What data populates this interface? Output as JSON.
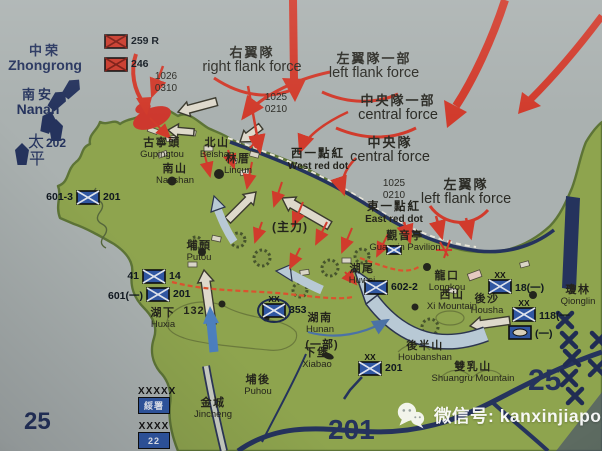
{
  "colors": {
    "sea": "#aab1b0",
    "land": "#8ea44b",
    "land_edge": "#5c7434",
    "navy": "#24335f",
    "red": "#d63a2a",
    "blue_unit": "#2e57a5",
    "white_arrow": "#ded9ca",
    "blue_arrow": "#b7c9d6",
    "text": "#26261e",
    "road_light": "#c9cdc2",
    "watermark": "#fdfdfd"
  },
  "sea_labels": [
    {
      "zh": "中荣",
      "en": "Zhongrong",
      "x": 45,
      "y": 44
    },
    {
      "zh": "南安",
      "en": "Nanan",
      "x": 38,
      "y": 88
    }
  ],
  "ship_group": {
    "name_vertical": [
      "太",
      "平"
    ],
    "number": "202"
  },
  "force_labels": [
    {
      "zh": "右翼隊",
      "en": "right flank force",
      "x": 252,
      "y": 46
    },
    {
      "zh": "左翼隊一部",
      "en": "left flank force",
      "x": 374,
      "y": 52
    },
    {
      "zh": "中央隊一部",
      "en": "central force",
      "x": 398,
      "y": 94
    },
    {
      "zh": "中央隊",
      "en": "central force",
      "x": 390,
      "y": 136
    },
    {
      "zh": "左翼隊",
      "en": "left flank force",
      "x": 466,
      "y": 178
    }
  ],
  "red_dot_labels": [
    {
      "zh": "西一點紅",
      "en": "West red dot",
      "x": 318,
      "y": 148
    },
    {
      "zh": "東一點紅",
      "en": "East red dot",
      "x": 394,
      "y": 201
    }
  ],
  "timestamps": [
    {
      "l1": "1026",
      "l2": "0310",
      "x": 166,
      "y": 71
    },
    {
      "l1": "1025",
      "l2": "0210",
      "x": 276,
      "y": 92
    },
    {
      "l1": "1025",
      "l2": "0210",
      "x": 394,
      "y": 178
    }
  ],
  "places": [
    {
      "zh": "古寧頭",
      "en": "Gupingtou",
      "x": 162,
      "y": 138
    },
    {
      "zh": "北山",
      "en": "Beishan",
      "x": 217,
      "y": 138
    },
    {
      "zh": "林厝",
      "en": "Lincun",
      "x": 238,
      "y": 154
    },
    {
      "zh": "南山",
      "en": "Nanshan",
      "x": 175,
      "y": 164
    },
    {
      "zh": "埔頭",
      "en": "Putou",
      "x": 199,
      "y": 241
    },
    {
      "zh": "湖下",
      "en": "Huxia",
      "x": 163,
      "y": 308
    },
    {
      "zh": "湖尾",
      "en": "Huwei",
      "x": 362,
      "y": 264
    },
    {
      "zh": "湖南",
      "en": "Hunan",
      "x": 320,
      "y": 313
    },
    {
      "zh": "下堡",
      "en": "Xiabao",
      "x": 317,
      "y": 348
    },
    {
      "zh": "埔後",
      "en": "Puhou",
      "x": 258,
      "y": 375
    },
    {
      "zh": "金城",
      "en": "Jincheng",
      "x": 213,
      "y": 398
    },
    {
      "zh": "觀音亭",
      "en": "Guanyin Pavilion",
      "x": 405,
      "y": 231
    },
    {
      "zh": "龍口",
      "en": "Longkou",
      "x": 447,
      "y": 271
    },
    {
      "zh": "西山",
      "en": "Xi Mountain",
      "x": 452,
      "y": 290
    },
    {
      "zh": "後沙",
      "en": "Housha",
      "x": 487,
      "y": 294
    },
    {
      "zh": "瓊林",
      "en": "Qionglin",
      "x": 578,
      "y": 285
    },
    {
      "zh": "後半山",
      "en": "Houbanshan",
      "x": 425,
      "y": 341
    },
    {
      "zh": "雙乳山",
      "en": "Shuangru Mountain",
      "x": 473,
      "y": 362
    }
  ],
  "annotations": [
    {
      "text": "(主力)",
      "x": 290,
      "y": 218,
      "size": 12
    },
    {
      "text": "(一部)",
      "x": 322,
      "y": 336,
      "size": 11
    },
    {
      "text": "132",
      "x": 194,
      "y": 305,
      "size": 11
    }
  ],
  "units": [
    {
      "side": "red",
      "post": "259 R",
      "x": 104,
      "y": 34
    },
    {
      "side": "red",
      "post": "246",
      "x": 104,
      "y": 57
    },
    {
      "side": "blue",
      "pre": "41",
      "post": "14",
      "x": 142,
      "y": 269
    },
    {
      "side": "blue",
      "pre": "601(一)",
      "post": "201",
      "x": 146,
      "y": 287
    },
    {
      "side": "blue",
      "pre": "601-3",
      "post": "201",
      "x": 76,
      "y": 190
    },
    {
      "side": "blue",
      "post": "602-2",
      "x": 364,
      "y": 280
    },
    {
      "side": "blue",
      "ech": "XX",
      "post": "18(一)",
      "x": 488,
      "y": 279
    },
    {
      "side": "blue",
      "ech": "XX",
      "post": "118(一",
      "x": 512,
      "y": 307
    },
    {
      "side": "blue",
      "tank": true,
      "post": "(一)",
      "x": 508,
      "y": 325
    },
    {
      "side": "blue",
      "ech": "XX",
      "circled": true,
      "post": "353",
      "x": 262,
      "y": 303
    },
    {
      "side": "blue",
      "ech": "XX",
      "flag": true,
      "post": "201",
      "x": 358,
      "y": 361
    },
    {
      "side": "blue",
      "post": "",
      "small": true,
      "x": 386,
      "y": 242
    }
  ],
  "legend": [
    {
      "echelon": "XXXXX",
      "label": "綏署",
      "x": 138,
      "y": 386
    },
    {
      "echelon": "XXXX",
      "label": "22",
      "x": 138,
      "y": 421
    }
  ],
  "big_numbers": [
    {
      "text": "201",
      "x": 328,
      "y": 414,
      "size": 28
    },
    {
      "text": "25",
      "x": 528,
      "y": 364,
      "size": 30
    },
    {
      "text": "25",
      "x": 24,
      "y": 408,
      "size": 24
    }
  ],
  "watermark": {
    "text": "微信号: kanxinjiapo"
  }
}
